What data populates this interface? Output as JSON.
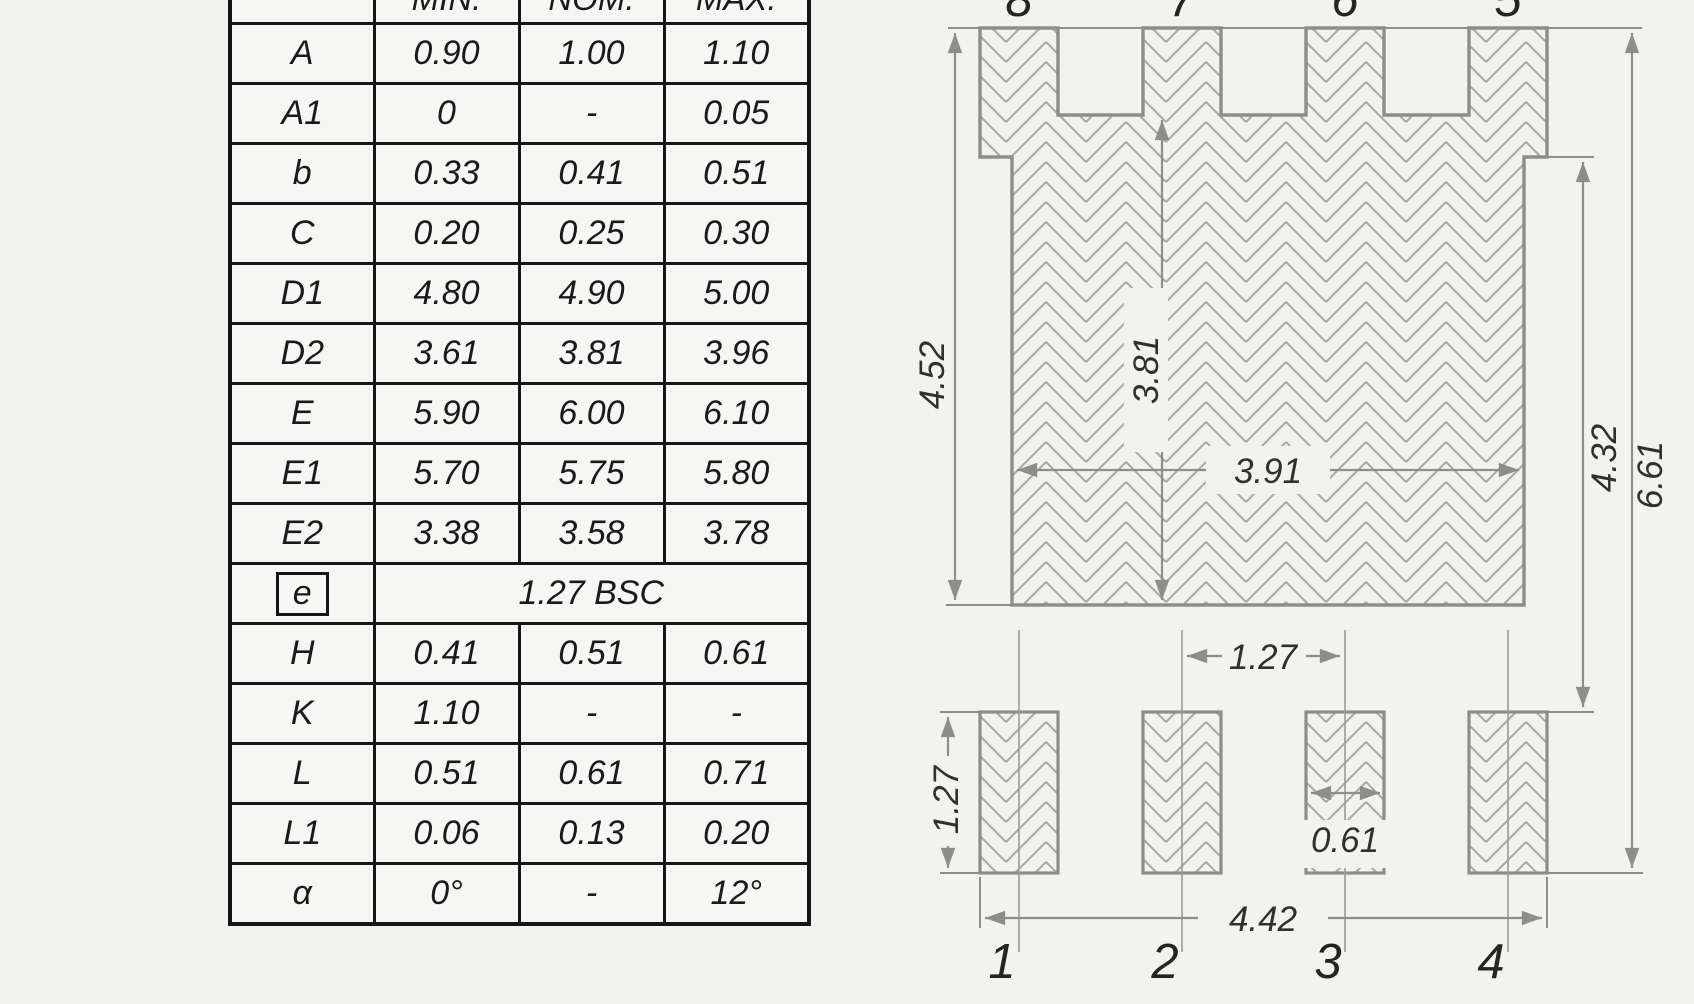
{
  "table": {
    "header": {
      "symbol": "",
      "min": "MIN.",
      "nom": "NOM.",
      "max": "MAX."
    },
    "rows": [
      {
        "sym": "A",
        "min": "0.90",
        "nom": "1.00",
        "max": "1.10"
      },
      {
        "sym": "A1",
        "min": "0",
        "nom": "-",
        "max": "0.05"
      },
      {
        "sym": "b",
        "min": "0.33",
        "nom": "0.41",
        "max": "0.51"
      },
      {
        "sym": "C",
        "min": "0.20",
        "nom": "0.25",
        "max": "0.30"
      },
      {
        "sym": "D1",
        "min": "4.80",
        "nom": "4.90",
        "max": "5.00"
      },
      {
        "sym": "D2",
        "min": "3.61",
        "nom": "3.81",
        "max": "3.96"
      },
      {
        "sym": "E",
        "min": "5.90",
        "nom": "6.00",
        "max": "6.10"
      },
      {
        "sym": "E1",
        "min": "5.70",
        "nom": "5.75",
        "max": "5.80"
      },
      {
        "sym": "E2",
        "min": "3.38",
        "nom": "3.58",
        "max": "3.78"
      },
      {
        "sym": "e",
        "boxed": true,
        "span": "1.27 BSC"
      },
      {
        "sym": "H",
        "min": "0.41",
        "nom": "0.51",
        "max": "0.61"
      },
      {
        "sym": "K",
        "min": "1.10",
        "nom": "-",
        "max": "-"
      },
      {
        "sym": "L",
        "min": "0.51",
        "nom": "0.61",
        "max": "0.71"
      },
      {
        "sym": "L1",
        "min": "0.06",
        "nom": "0.13",
        "max": "0.20"
      },
      {
        "sym": "α",
        "min": "0°",
        "nom": "-",
        "max": "12°"
      }
    ]
  },
  "drawing": {
    "top_pin_labels": [
      "8",
      "7",
      "6",
      "5"
    ],
    "bottom_pin_labels": [
      "1",
      "2",
      "3",
      "4"
    ],
    "dims": {
      "overall_height": "4.52",
      "inner_height": "3.81",
      "body_width": "3.91",
      "right_height": "4.32",
      "total_height": "6.61",
      "pad_pitch": "1.27",
      "pad_height": "1.27",
      "pad_width": "0.61",
      "pad_span": "4.42"
    },
    "colors": {
      "outline": "#8d8d8b",
      "hatch": "#a8a8a6",
      "dim_text": "#30302e",
      "table_line": "#161616",
      "background": "#f2f2f0"
    }
  }
}
